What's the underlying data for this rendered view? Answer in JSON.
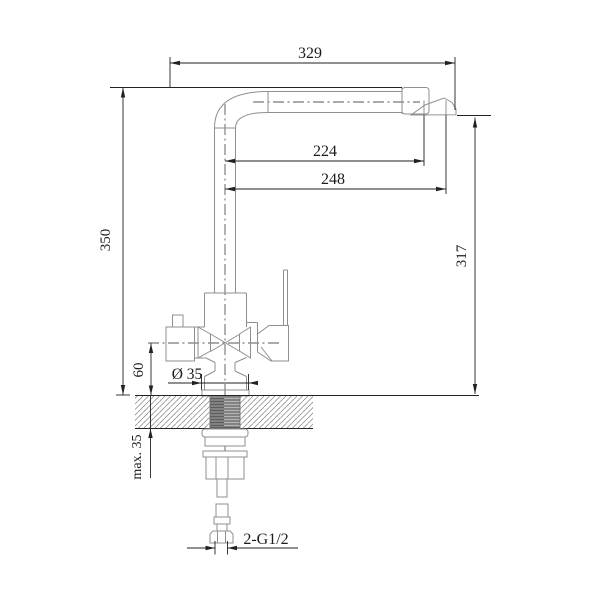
{
  "drawing": {
    "kind": "technical-dimension-drawing",
    "subject": "kitchen-sink-mixer-faucet-side-elevation",
    "labels": {
      "overall_width": "329",
      "reach_to_aerator_center": "224",
      "reach_to_spout_tip": "248",
      "overall_height": "350",
      "outlet_height": "317",
      "port_center_height": "60",
      "base_diameter": "Ø 35",
      "max_deck_thickness": "max. 35",
      "inlet_connection": "2-G1/2"
    },
    "colors": {
      "background": "#ffffff",
      "outline": "#8f8f8f",
      "dimension": "#222222",
      "centerline": "#555555",
      "hatch": "#7a7a7a",
      "thread_fill": "#b5b5b5",
      "thread_line": "#4f4f4f"
    }
  }
}
